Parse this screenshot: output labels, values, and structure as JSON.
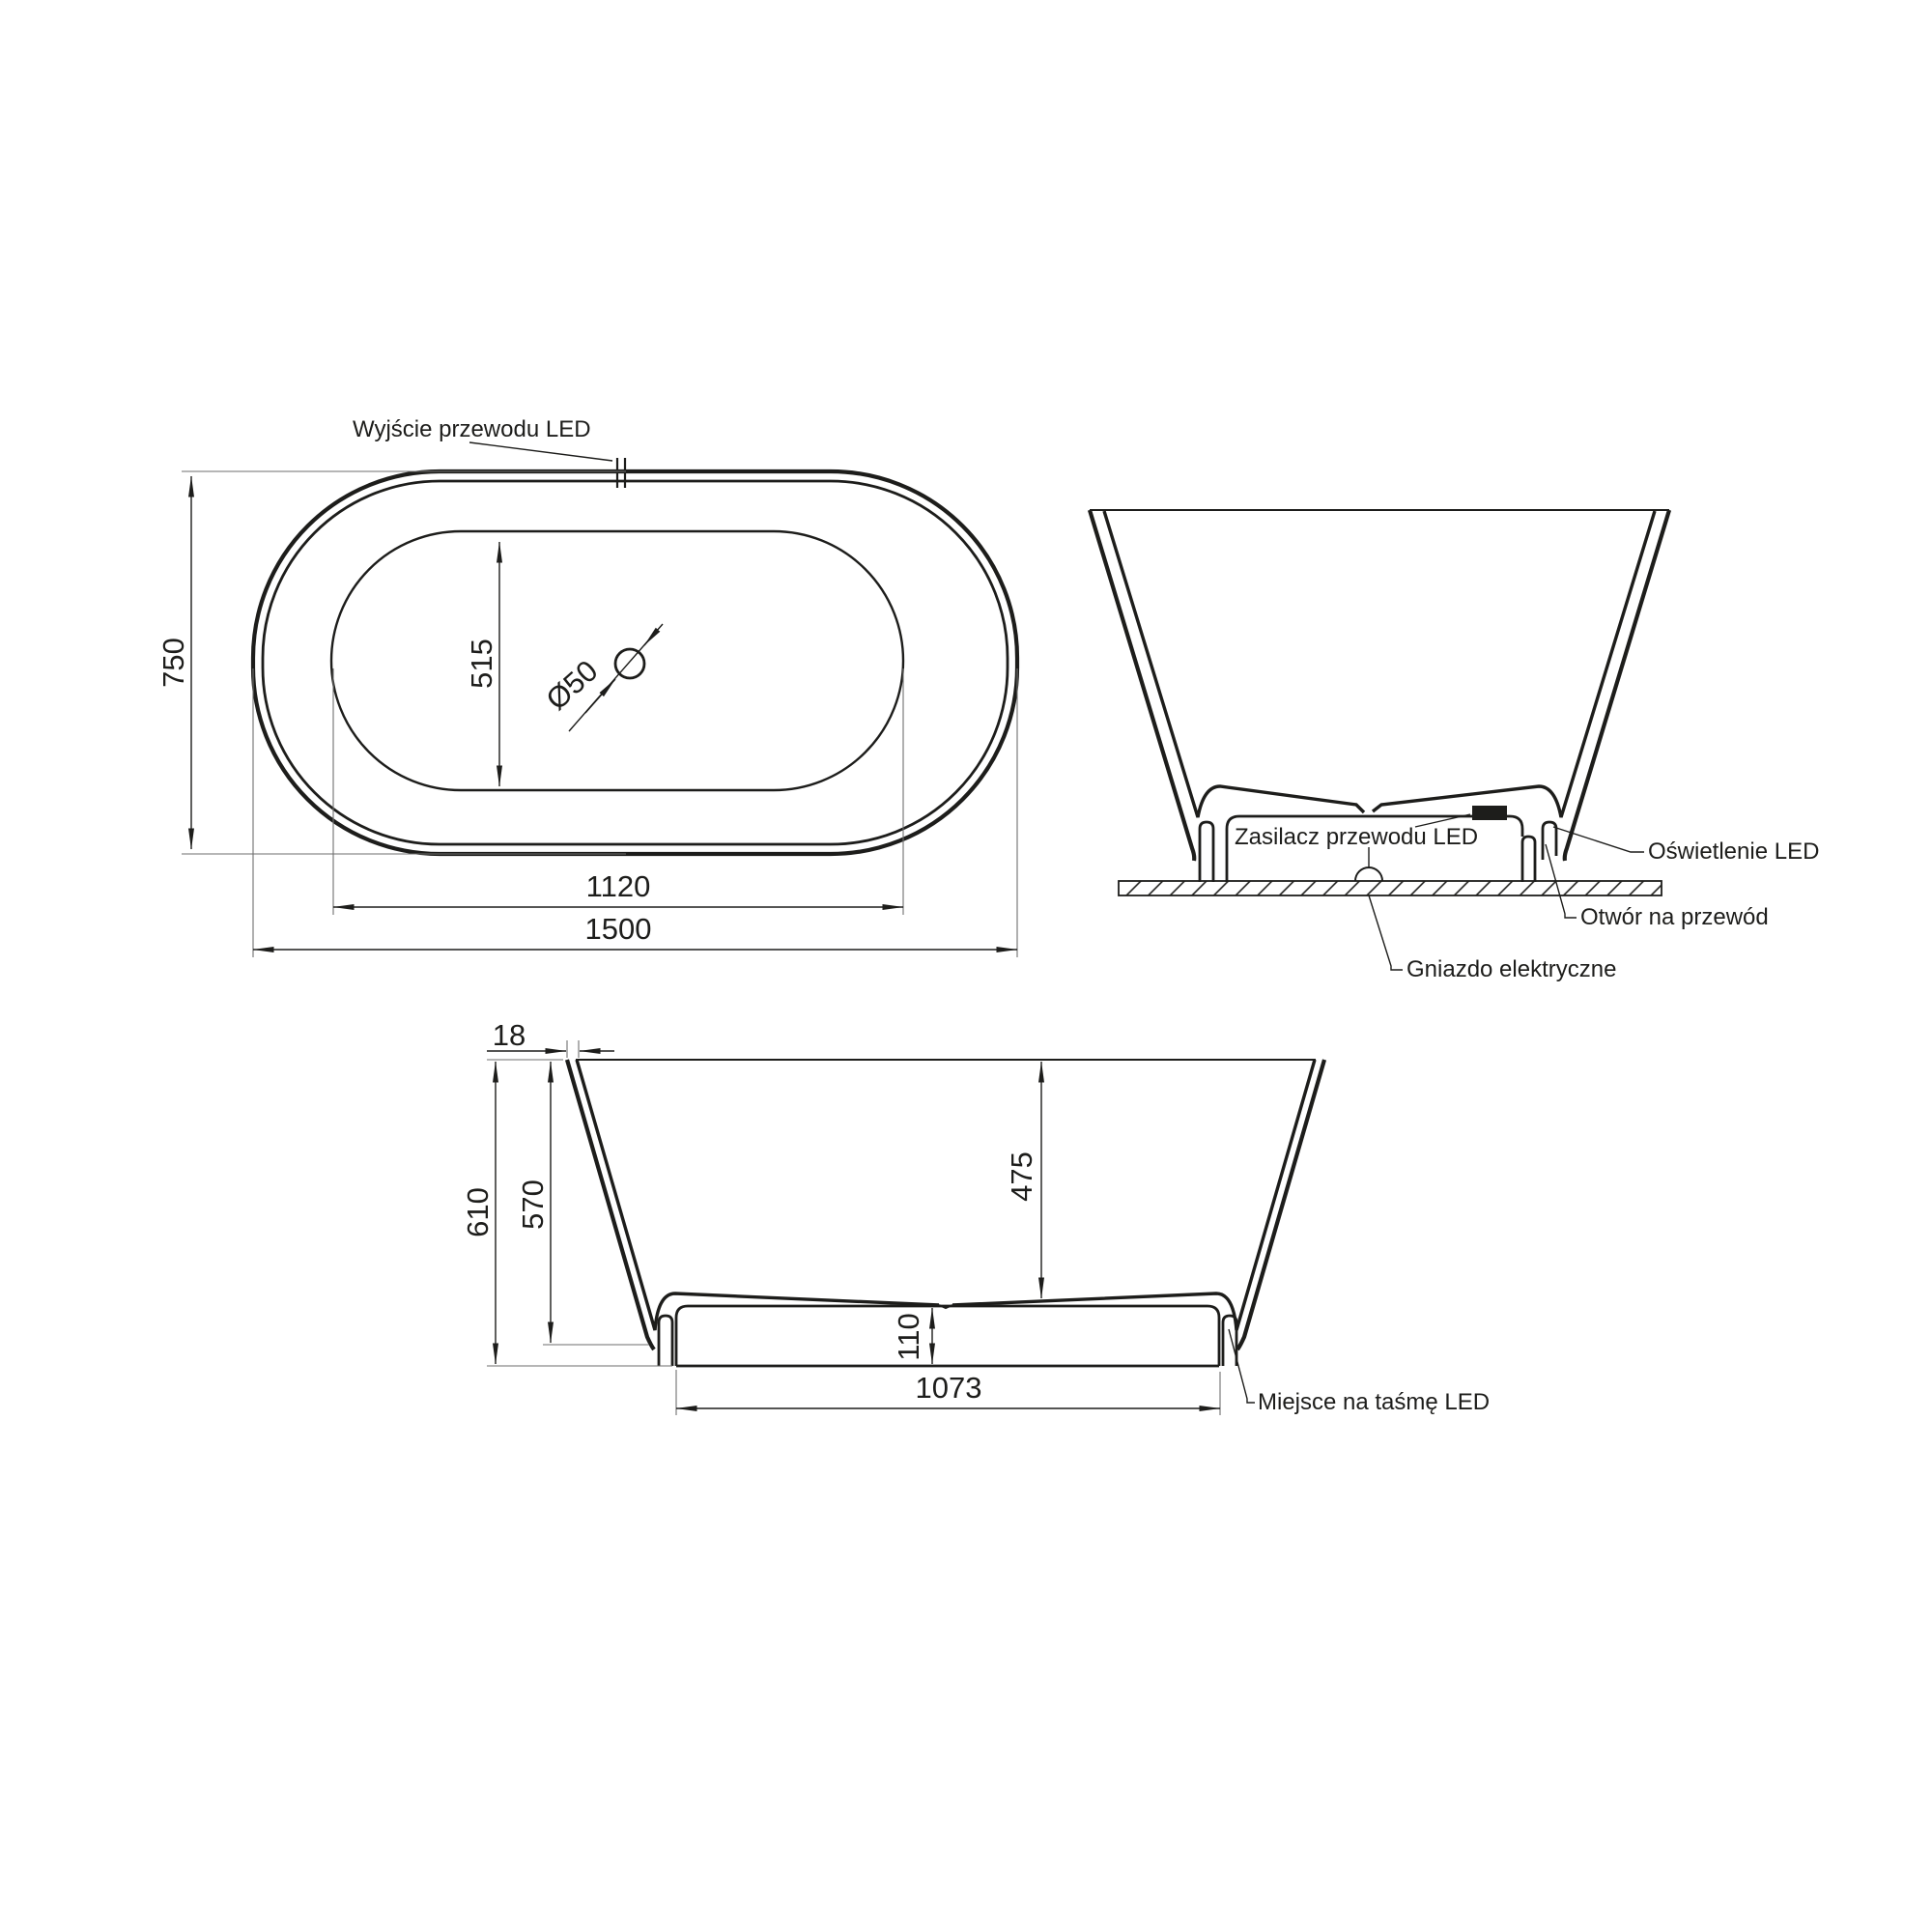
{
  "colors": {
    "ink": "#1d1d1b",
    "background": "#ffffff"
  },
  "plan_view": {
    "led_exit_label": "Wyjście przewodu LED",
    "overall_width": "750",
    "inner_width": "515",
    "drain_diameter": "Ø50",
    "inner_length": "1120",
    "overall_length": "1500"
  },
  "end_view": {
    "power_supply_label": "Zasilacz przewodu LED",
    "led_lighting_label": "Oświetlenie LED",
    "cable_hole_label": "Otwór na przewód",
    "socket_label": "Gniazdo elektryczne"
  },
  "side_view": {
    "rim_thickness": "18",
    "overall_height": "610",
    "shell_height": "570",
    "inner_depth": "475",
    "base_height": "110",
    "base_length": "1073",
    "led_strip_label": "Miejsce na taśmę LED"
  }
}
